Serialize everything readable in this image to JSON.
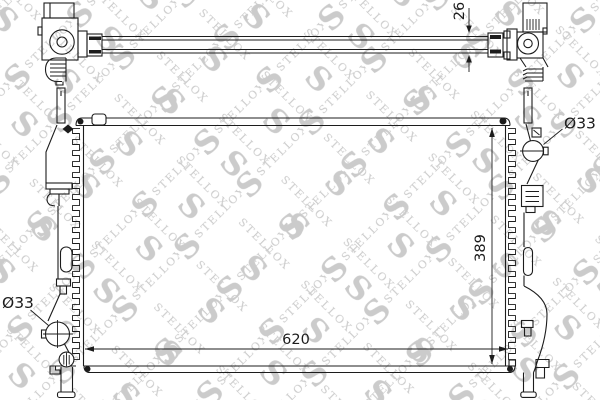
{
  "watermark": {
    "brand": "STELLOX",
    "monogram": "S"
  },
  "dimensions": {
    "crossbar_height_mm": "26",
    "core_width_mm": "620",
    "core_height_mm": "389",
    "top_pipe_diameter": "Ø33",
    "bottom_pipe_diameter": "Ø33"
  },
  "colors": {
    "line": "#1c1c1c",
    "background": "#ffffff",
    "watermark": "#cbcbcb"
  }
}
